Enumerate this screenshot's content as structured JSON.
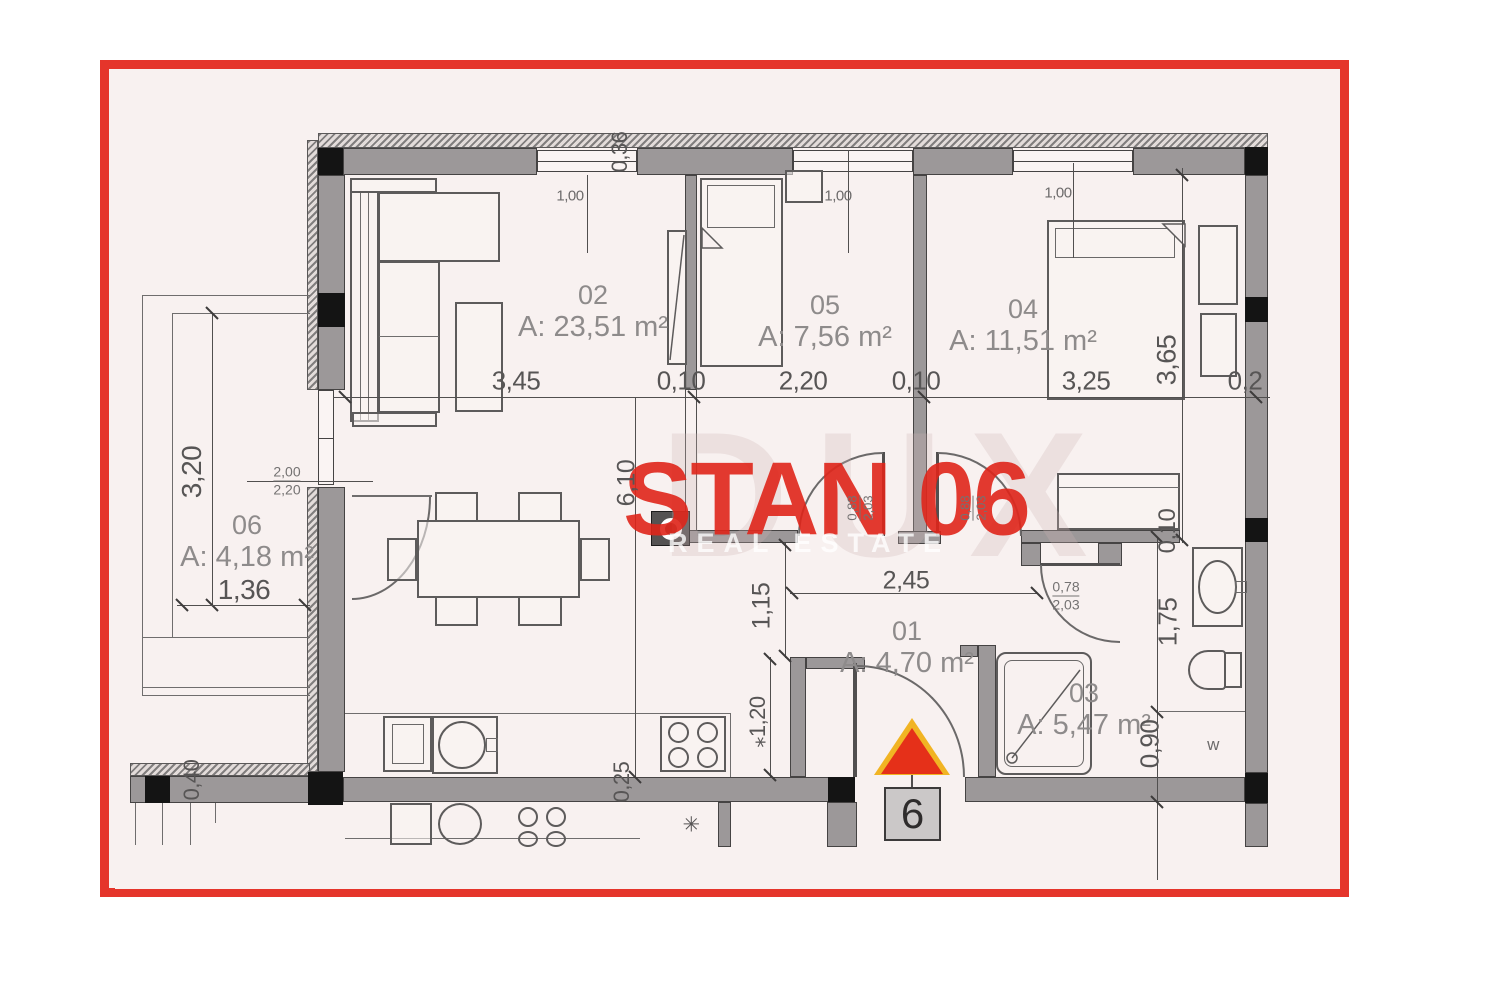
{
  "plan": {
    "title": "STAN 06",
    "watermark_primary": "DUX",
    "watermark_secondary": "REAL ESTATE",
    "entrance_number": "6",
    "rooms": [
      {
        "id": "02",
        "area": "A: 23,51 m²"
      },
      {
        "id": "05",
        "area": "A: 7,56 m²"
      },
      {
        "id": "04",
        "area": "A: 11,51 m²"
      },
      {
        "id": "06",
        "area": "A: 4,18 m²"
      },
      {
        "id": "01",
        "area": "A: 4,70 m²"
      },
      {
        "id": "03",
        "area": "A: 5,47 m²"
      }
    ],
    "dims": {
      "top_chain": [
        "3,45",
        "0,10",
        "2,20",
        "0,10",
        "3,25",
        "0,2"
      ],
      "window1": "1,00",
      "window2": "1,00",
      "window3": "1,00",
      "top_wall_thickness": "0,36",
      "balcony_height": "3,20",
      "balcony_width": "1,36",
      "balcony_door_w": "2,00",
      "balcony_door_h": "2,20",
      "mid_height": "6,10",
      "hall_opening": "1,15",
      "hall_width": "2,45",
      "door05_w": "0,88",
      "door05_h": "2,03",
      "door04_w": "0,88",
      "door04_h": "2,03",
      "bath_door_w": "0,78",
      "bath_door_h": "2,03",
      "kitchen_pass": "⁎1,20",
      "bottom_wall_thickness": "0,25",
      "left_bottom_wall": "0,40",
      "bath_wall_gap": "0,10",
      "bath_len1": "1,75",
      "bath_len2": "0,90",
      "room04_height": "3,65",
      "washer_label": "w",
      "star": "✳"
    },
    "colors": {
      "frame_red": "#e5352b",
      "title_red": "#df251a",
      "wall_gray": "#9c9899",
      "marker_red": "#e53019",
      "marker_yellow": "#f1b423"
    }
  }
}
